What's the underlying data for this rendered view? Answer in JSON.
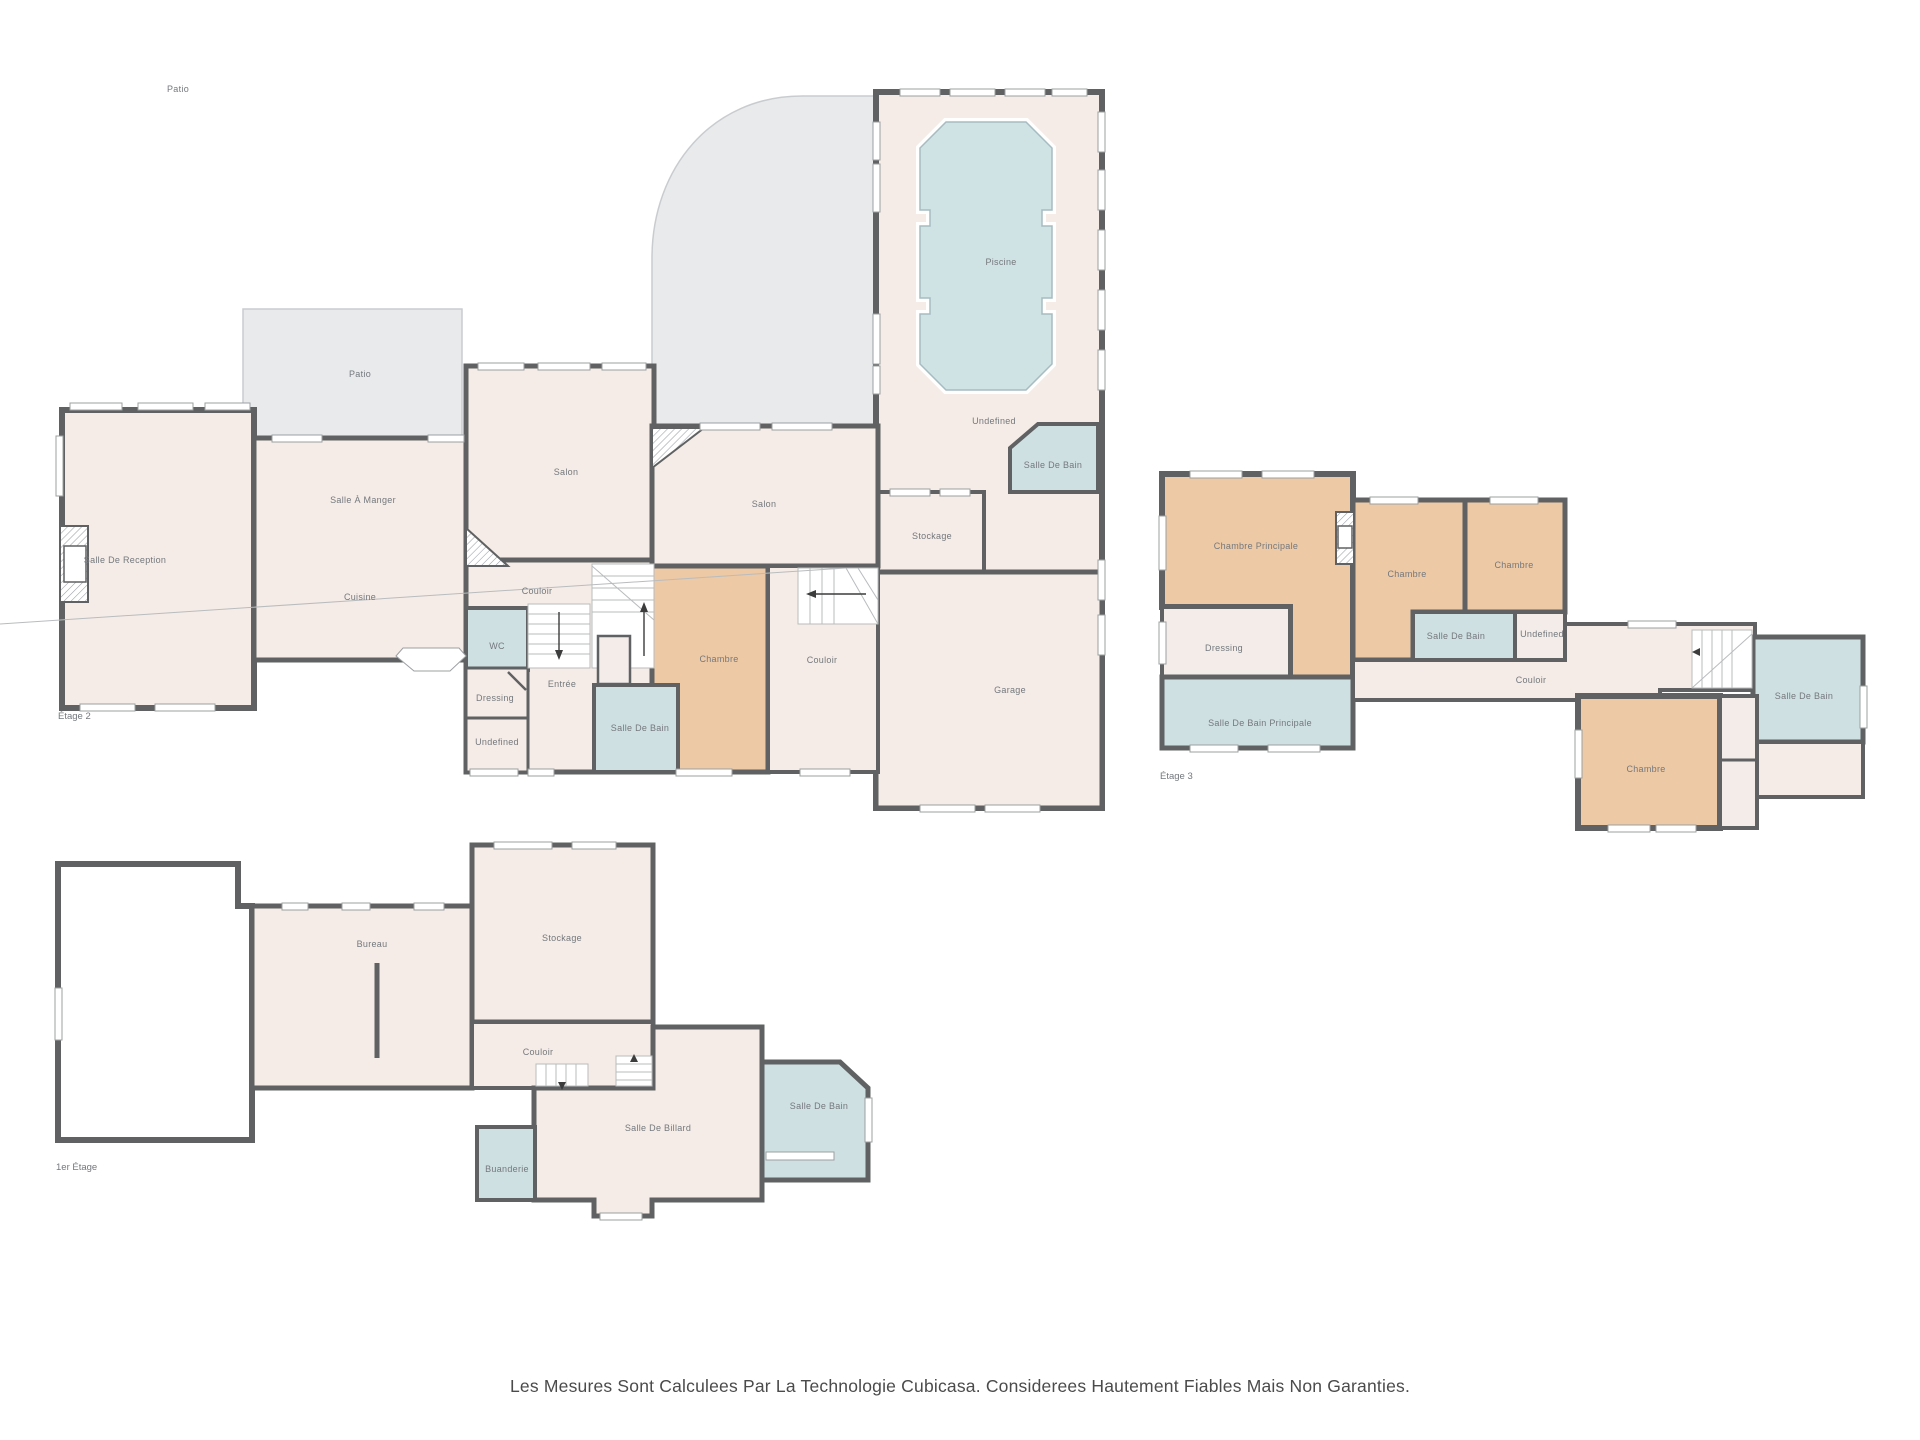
{
  "page": {
    "footer_disclaimer": "Les Mesures Sont Calculees Par La Technologie Cubicasa. Considerees Hautement Fiables Mais Non Garanties.",
    "stray_label": "Patio"
  },
  "colors": {
    "wall": "#5f6162",
    "floor": "#f5ece7",
    "outdoor": "#e9eaec",
    "bedroom": "#edc9a5",
    "bathroom": "#cfe0e3",
    "pool_water": "#cfe2e4",
    "label_text": "#74787d",
    "footer_text": "#4b4b4b"
  },
  "floors": [
    {
      "name": "Étage 2",
      "rooms": [
        {
          "label": "Salle De Reception",
          "type": "floor"
        },
        {
          "label": "Patio",
          "type": "outdoor"
        },
        {
          "label": "Salle À Manger",
          "type": "floor"
        },
        {
          "label": "Cuisine",
          "type": "floor"
        },
        {
          "label": "Salon",
          "type": "floor"
        },
        {
          "label": "Couloir",
          "type": "floor"
        },
        {
          "label": "WC",
          "type": "bathroom"
        },
        {
          "label": "Dressing",
          "type": "floor"
        },
        {
          "label": "Entrée",
          "type": "floor"
        },
        {
          "label": "Undefined",
          "type": "floor"
        },
        {
          "label": "Salle De Bain",
          "type": "bathroom"
        },
        {
          "label": "Chambre",
          "type": "bedroom"
        },
        {
          "label": "Salon",
          "type": "floor"
        },
        {
          "label": "Couloir",
          "type": "floor"
        },
        {
          "label": "Stockage",
          "type": "floor"
        },
        {
          "label": "Piscine",
          "type": "pool"
        },
        {
          "label": "Undefined",
          "type": "floor"
        },
        {
          "label": "Salle De Bain",
          "type": "bathroom"
        },
        {
          "label": "Garage",
          "type": "floor"
        }
      ]
    },
    {
      "name": "1er Étage",
      "rooms": [
        {
          "label": "Bureau",
          "type": "floor"
        },
        {
          "label": "Stockage",
          "type": "floor"
        },
        {
          "label": "Couloir",
          "type": "floor"
        },
        {
          "label": "Salle De Billard",
          "type": "floor"
        },
        {
          "label": "Salle De Bain",
          "type": "bathroom"
        },
        {
          "label": "Buanderie",
          "type": "bathroom"
        }
      ]
    },
    {
      "name": "Étage 3",
      "rooms": [
        {
          "label": "Chambre Principale",
          "type": "bedroom"
        },
        {
          "label": "Chambre",
          "type": "bedroom"
        },
        {
          "label": "Chambre",
          "type": "bedroom"
        },
        {
          "label": "Dressing",
          "type": "floor"
        },
        {
          "label": "Salle De Bain",
          "type": "bathroom"
        },
        {
          "label": "Undefined",
          "type": "floor"
        },
        {
          "label": "Salle De Bain Principale",
          "type": "bathroom"
        },
        {
          "label": "Couloir",
          "type": "floor"
        },
        {
          "label": "Chambre",
          "type": "bedroom"
        },
        {
          "label": "Salle De Bain",
          "type": "bathroom"
        }
      ]
    }
  ]
}
